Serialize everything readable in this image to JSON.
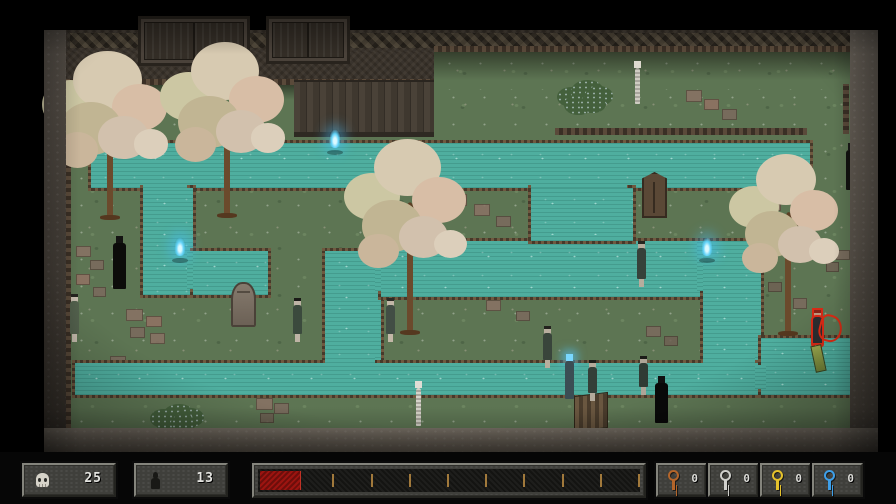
{
  "hud": {
    "skull_counter": {
      "icon": "skull-icon",
      "value": "25"
    },
    "figure_counter": {
      "icon": "person-icon",
      "value": "13"
    },
    "progress_bar": {
      "fill_pct": 10.5,
      "fill_color": "#9c1410",
      "tick_color": "#a1793b",
      "ticks_pct": [
        20,
        30,
        40,
        50,
        60,
        70,
        80,
        90,
        100
      ]
    },
    "keys": [
      {
        "name": "copper-key",
        "color": "#b4652a",
        "count": "0"
      },
      {
        "name": "silver-key",
        "color": "#cfcfcb",
        "count": "0"
      },
      {
        "name": "gold-key",
        "color": "#e5c22c",
        "count": "0"
      },
      {
        "name": "blue-key",
        "color": "#3e9fe8",
        "count": "0"
      }
    ]
  },
  "scene": {
    "palette": {
      "grass": "#5d7553",
      "water": "#4fae9f",
      "canal_border": "#47392a",
      "wall_dark": "#3a332b",
      "stone": "#6b6257",
      "wisp_blue": "#62d2f8",
      "player_outline": "#d92a16",
      "tile_colors": [
        "#8a7265",
        "#7c6a5e",
        "#937264",
        "#6f6053"
      ]
    },
    "grass": [
      [
        66,
        84,
        784,
        344
      ],
      [
        434,
        50,
        416,
        40
      ]
    ],
    "wallbands": [
      [
        66,
        30,
        790,
        22
      ],
      [
        66,
        52,
        368,
        32
      ]
    ],
    "diamond_rows": [
      [
        70,
        33,
        780,
        15
      ]
    ],
    "shades": [
      [
        434,
        50,
        416,
        30
      ],
      [
        66,
        84,
        368,
        16
      ]
    ],
    "side_walls": {
      "left": [
        44,
        30,
        22,
        422
      ],
      "right": [
        850,
        30,
        28,
        422
      ],
      "bottom": [
        44,
        428,
        834,
        26
      ]
    },
    "brick_rows": [
      [
        66,
        79,
        368,
        6
      ],
      [
        434,
        46,
        416,
        6
      ],
      [
        555,
        128,
        252,
        7
      ],
      [
        64,
        84,
        7,
        344
      ],
      [
        843,
        84,
        6,
        50
      ]
    ],
    "tiles": [
      [
        76,
        246,
        13,
        9,
        0
      ],
      [
        90,
        260,
        12,
        8,
        1
      ],
      [
        76,
        274,
        12,
        9,
        2
      ],
      [
        93,
        287,
        11,
        8,
        1
      ],
      [
        150,
        238,
        15,
        10,
        1
      ],
      [
        168,
        243,
        13,
        9,
        0
      ],
      [
        126,
        309,
        15,
        10,
        0
      ],
      [
        146,
        316,
        14,
        9,
        2
      ],
      [
        130,
        327,
        13,
        9,
        1
      ],
      [
        150,
        333,
        13,
        9,
        0
      ],
      [
        110,
        356,
        14,
        10,
        1
      ],
      [
        131,
        363,
        13,
        9,
        3
      ],
      [
        256,
        398,
        15,
        10,
        0
      ],
      [
        274,
        403,
        13,
        9,
        1
      ],
      [
        260,
        413,
        12,
        8,
        3
      ],
      [
        450,
        194,
        15,
        10,
        2
      ],
      [
        474,
        204,
        14,
        10,
        0
      ],
      [
        496,
        216,
        13,
        9,
        1
      ],
      [
        686,
        90,
        14,
        10,
        0
      ],
      [
        704,
        99,
        13,
        9,
        2
      ],
      [
        722,
        109,
        13,
        9,
        1
      ],
      [
        766,
        200,
        13,
        9,
        0
      ],
      [
        800,
        229,
        13,
        9,
        2
      ],
      [
        793,
        298,
        12,
        9,
        1
      ],
      [
        768,
        282,
        12,
        8,
        3
      ],
      [
        486,
        300,
        13,
        9,
        0
      ],
      [
        516,
        311,
        12,
        8,
        1
      ],
      [
        646,
        326,
        13,
        9,
        1
      ],
      [
        664,
        336,
        12,
        8,
        3
      ],
      [
        836,
        250,
        12,
        8,
        1
      ],
      [
        826,
        262,
        11,
        8,
        3
      ]
    ],
    "water": [
      [
        88,
        140,
        719,
        45
      ],
      [
        140,
        185,
        50,
        107
      ],
      [
        190,
        248,
        75,
        44
      ],
      [
        322,
        248,
        56,
        115
      ],
      [
        378,
        238,
        380,
        56
      ],
      [
        528,
        185,
        102,
        53
      ],
      [
        700,
        238,
        58,
        125
      ],
      [
        72,
        360,
        691,
        32
      ],
      [
        758,
        335,
        100,
        57
      ]
    ],
    "water_patches": [
      [
        143,
        182,
        44,
        6
      ],
      [
        187,
        251,
        6,
        38
      ],
      [
        375,
        251,
        6,
        40
      ],
      [
        531,
        235,
        96,
        6
      ],
      [
        531,
        182,
        96,
        6
      ],
      [
        697,
        241,
        6,
        50
      ],
      [
        325,
        357,
        50,
        6
      ],
      [
        703,
        357,
        52,
        6
      ],
      [
        755,
        365,
        11,
        24
      ]
    ],
    "props": [
      {
        "type": "gate",
        "r": [
          138,
          16,
          106,
          44
        ]
      },
      {
        "type": "gate",
        "r": [
          266,
          16,
          78,
          42
        ]
      },
      {
        "type": "fence",
        "r": [
          294,
          80,
          140,
          50
        ]
      },
      {
        "type": "grave",
        "r": [
          231,
          282,
          21,
          41
        ]
      },
      {
        "type": "outhouse",
        "r": [
          642,
          172,
          21,
          42
        ]
      },
      {
        "type": "slats",
        "r": [
          574,
          394,
          32,
          34
        ]
      }
    ],
    "over_props": [
      {
        "type": "scribble",
        "r": [
          819,
          315,
          19,
          23
        ]
      },
      {
        "type": "item",
        "r": [
          813,
          345,
          9,
          25
        ]
      }
    ],
    "bushes": [
      [
        551,
        77,
        48,
        39
      ],
      [
        144,
        402,
        46,
        27
      ]
    ],
    "bush_blobs": [
      [
        0.12,
        0.25,
        0.3
      ],
      [
        0.42,
        0.08,
        0.34
      ],
      [
        0.7,
        0.22,
        0.3
      ],
      [
        0.27,
        0.45,
        0.3
      ],
      [
        0.58,
        0.45,
        0.28
      ]
    ],
    "trees": [
      [
        52,
        68,
        115,
        152
      ],
      [
        170,
        58,
        114,
        160
      ],
      [
        354,
        153,
        112,
        182
      ],
      [
        738,
        166,
        100,
        170
      ]
    ],
    "tree_blobs": [
      [
        0.16,
        0.24,
        0.25
      ],
      [
        0.48,
        0.08,
        0.3
      ],
      [
        0.76,
        0.26,
        0.24
      ],
      [
        0.34,
        0.4,
        0.27
      ],
      [
        0.62,
        0.46,
        0.22
      ],
      [
        0.22,
        0.54,
        0.18
      ],
      [
        0.86,
        0.5,
        0.15
      ]
    ],
    "tree_colors": [
      "#ccc7a3",
      "#d7cab1",
      "#d8bea6",
      "#c1b593",
      "#d2c1ad",
      "#cab69b",
      "#dccfbb"
    ],
    "wisps": [
      [
        329,
        129
      ],
      [
        174,
        237
      ],
      [
        701,
        237
      ]
    ],
    "characters": [
      {
        "r": [
          631,
          61,
          12,
          43
        ],
        "name": "skeleton",
        "cls": "thin",
        "head": "#ddd9cf",
        "body": "#cfccc2"
      },
      {
        "r": [
          845,
          143,
          13,
          47
        ],
        "name": "dark-figure",
        "cls": "robed",
        "head": "#1a1a18",
        "body": "#121210"
      },
      {
        "r": [
          112,
          236,
          15,
          53
        ],
        "name": "dark-figure",
        "cls": "robed",
        "head": "#141412",
        "body": "#0c0c0a"
      },
      {
        "r": [
          68,
          294,
          12,
          48
        ],
        "name": "ghost-girl",
        "hair": "#24241f",
        "head": "#c6bcae",
        "body": "#53614d"
      },
      {
        "r": [
          291,
          298,
          13,
          44
        ],
        "name": "ghost-girl",
        "hair": "#1a1a17",
        "head": "#beb4a5",
        "body": "#3b4a3d"
      },
      {
        "r": [
          384,
          298,
          12,
          44
        ],
        "name": "villager",
        "hair": "#2b2b26",
        "head": "#c2b7a7",
        "body": "#424e45"
      },
      {
        "r": [
          541,
          326,
          12,
          42
        ],
        "name": "villager",
        "hair": "#23231e",
        "head": "#b8ae9e",
        "body": "#39453b"
      },
      {
        "r": [
          412,
          381,
          13,
          45
        ],
        "name": "skeleton",
        "cls": "thin",
        "head": "#e0ddd5",
        "body": "#d5d2c9"
      },
      {
        "r": [
          563,
          354,
          13,
          45
        ],
        "name": "blue-flame-figure",
        "cls": "glow",
        "head": "#7ad8ff",
        "body": "#3b4d54"
      },
      {
        "r": [
          586,
          360,
          12,
          41
        ],
        "name": "ghost-girl",
        "hair": "#1d1d19",
        "head": "#b4aa9b",
        "body": "#343f38"
      },
      {
        "r": [
          638,
          356,
          11,
          39
        ],
        "name": "ghost-girl",
        "hair": "#1b1b17",
        "head": "#afa597",
        "body": "#303b34"
      },
      {
        "r": [
          654,
          376,
          15,
          47
        ],
        "name": "dark-figure",
        "cls": "robed",
        "head": "#101010",
        "body": "#090909"
      },
      {
        "r": [
          635,
          241,
          13,
          46
        ],
        "name": "villager",
        "hair": "#26261f",
        "head": "#b7ad9d",
        "body": "#36413a"
      },
      {
        "r": [
          810,
          310,
          14,
          43
        ],
        "name": "player-character",
        "cls": "outline",
        "hair": "#8a2416",
        "head": "#c2997f",
        "body": "#2d2d30"
      }
    ]
  }
}
